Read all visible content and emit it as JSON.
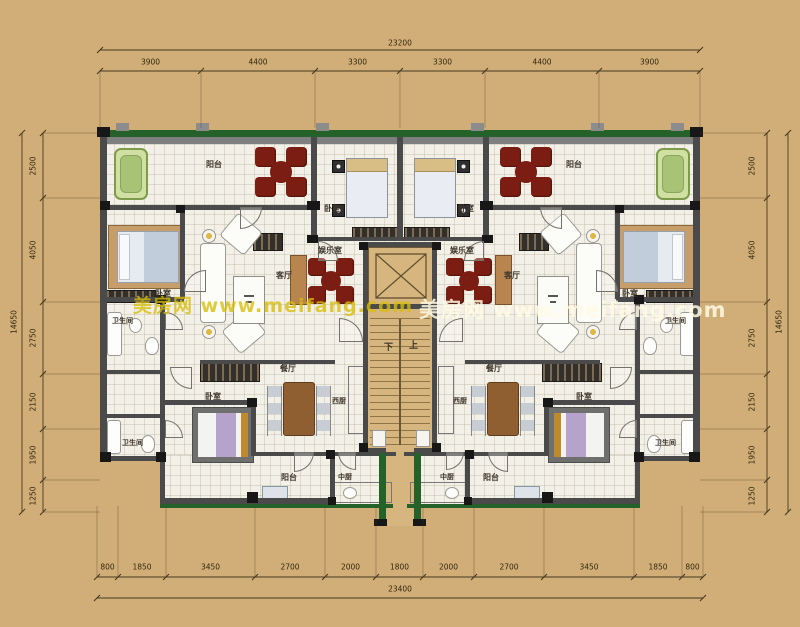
{
  "watermark": {
    "text": "美房网 www.meifang.com"
  },
  "dimensions": {
    "top": {
      "total": "23200",
      "segments": [
        "3900",
        "4400",
        "3300",
        "3300",
        "4400",
        "3900"
      ]
    },
    "bottom": {
      "total": "23400",
      "segments": [
        "800",
        "1850",
        "3450",
        "2700",
        "2000",
        "1800",
        "2000",
        "2700",
        "3450",
        "1850",
        "800"
      ]
    },
    "left": {
      "total": "14650",
      "segments": [
        "2500",
        "4050",
        "2750",
        "2150",
        "1950",
        "1250"
      ]
    },
    "right": {
      "total": "14650",
      "segments": [
        "2500",
        "4050",
        "2750",
        "2150",
        "1950",
        "1250"
      ]
    }
  },
  "rooms": {
    "balcony": "阳台",
    "bedroom": "卧室",
    "entertainment": "娱乐室",
    "living": "客厅",
    "bathroom": "卫生间",
    "dining": "餐厅",
    "west_kitchen": "西厨",
    "chinese_kitchen": "中厨",
    "stairs_down": "下",
    "stairs_up": "上"
  },
  "colors": {
    "background": "#d1ad77",
    "floor": "#f3f0e7",
    "wall_gray": "#4a4a4a",
    "hedge_green": "#25622a",
    "core_tan": "#d6b57e",
    "table_red": "#7b1d12",
    "watermark_left": "#d8be0a",
    "watermark_right": "#fffbe4"
  }
}
